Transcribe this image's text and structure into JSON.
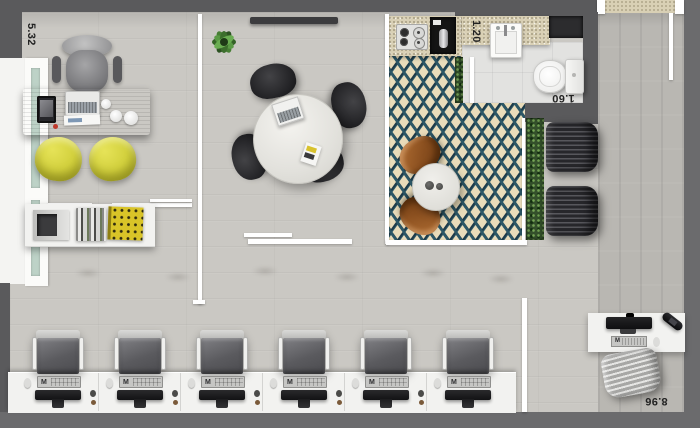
{
  "dimensions": {
    "office_width": "5.32",
    "kitchen_width": "1.20",
    "bathroom_width": "1.60",
    "plan_depth": "8.96"
  },
  "workstations": {
    "count": 6,
    "keyboard_logo": "M"
  },
  "right_desk": {
    "keyboard_logo": "M"
  },
  "colors": {
    "wall": "#5a5a5c",
    "wall_light": "#6b6b6d",
    "floor": "#cac8c3",
    "corridor": "#b9b7b2",
    "checker_teal": "#2c5766",
    "checker_navy": "#1d3a49",
    "checker_cream": "#e9dcba",
    "counter": "#d9d0b5",
    "hedge": "#34502b",
    "bench": "#2e2e32",
    "wood": "#6b4423",
    "yellow": "#d3d13e",
    "black_chair": "#232326",
    "white_furniture": "#f2f2f0",
    "glass": "#bdd2c7",
    "text": "#222222"
  }
}
